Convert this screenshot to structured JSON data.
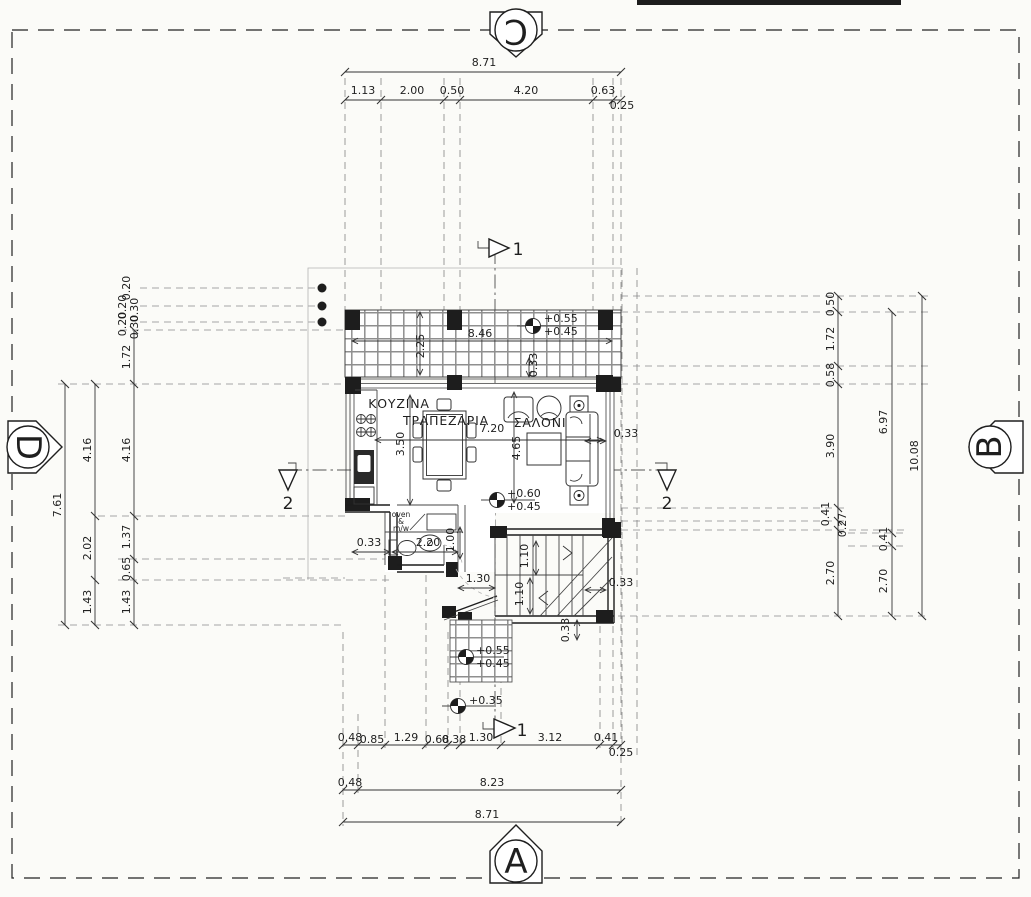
{
  "drawing": {
    "kind": "architectural floor plan",
    "rooms": [
      "ΚΟΥΖΙΝΑ",
      "ΤΡΑΠΕΖΑΡΙΑ",
      "ΣΑΛΟΝΙ"
    ],
    "elevation_markers": [
      {
        "letter": "C",
        "position": "top"
      },
      {
        "letter": "A",
        "position": "bottom"
      },
      {
        "letter": "D",
        "position": "left"
      },
      {
        "letter": "B",
        "position": "right"
      }
    ],
    "section_markers": [
      "1",
      "2"
    ],
    "levels": [
      "+0.55",
      "+0.45",
      "+0.60",
      "+0.45",
      "+0.55",
      "+0.45",
      "+0.35"
    ],
    "colors": {
      "paper": "#fbfbf8",
      "ink": "#1d1d1d",
      "dash": "#8a8a8a",
      "tile": "#8f8f8f"
    }
  },
  "annotations": [
    {
      "t": "8.71",
      "x": 484,
      "y": 66,
      "c": "dim"
    },
    {
      "t": "1.13",
      "x": 363,
      "y": 94,
      "c": "dim"
    },
    {
      "t": "2.00",
      "x": 412,
      "y": 94,
      "c": "dim"
    },
    {
      "t": "0.50",
      "x": 452,
      "y": 94,
      "c": "dim"
    },
    {
      "t": "4.20",
      "x": 526,
      "y": 94,
      "c": "dim"
    },
    {
      "t": "0.63",
      "x": 603,
      "y": 94,
      "c": "dim"
    },
    {
      "t": "0.25",
      "x": 622,
      "y": 109,
      "c": "dim"
    },
    {
      "t": "7.61",
      "x": 61,
      "y": 505,
      "r": -90,
      "c": "dim"
    },
    {
      "t": "4.16",
      "x": 91,
      "y": 450,
      "r": -90,
      "c": "dim"
    },
    {
      "t": "2.02",
      "x": 91,
      "y": 548,
      "r": -90,
      "c": "dim"
    },
    {
      "t": "1.43",
      "x": 91,
      "y": 602,
      "r": -90,
      "c": "dim"
    },
    {
      "t": "0.20",
      "x": 130,
      "y": 288,
      "r": -90,
      "c": "dim"
    },
    {
      "t": "0.20",
      "x": 126,
      "y": 307,
      "r": -90,
      "c": "dim"
    },
    {
      "t": "0.30",
      "x": 138,
      "y": 310,
      "r": -90,
      "c": "dim"
    },
    {
      "t": "0.20",
      "x": 126,
      "y": 324,
      "r": -90,
      "c": "dim"
    },
    {
      "t": "0.30",
      "x": 138,
      "y": 327,
      "r": -90,
      "c": "dim"
    },
    {
      "t": "1.72",
      "x": 130,
      "y": 357,
      "r": -90,
      "c": "dim"
    },
    {
      "t": "4.16",
      "x": 130,
      "y": 450,
      "r": -90,
      "c": "dim"
    },
    {
      "t": "1.37",
      "x": 130,
      "y": 537,
      "r": -90,
      "c": "dim"
    },
    {
      "t": "0.65",
      "x": 130,
      "y": 569,
      "r": -90,
      "c": "dim"
    },
    {
      "t": "1.43",
      "x": 130,
      "y": 602,
      "r": -90,
      "c": "dim"
    },
    {
      "t": "0.50",
      "x": 834,
      "y": 304,
      "r": -90,
      "c": "dim"
    },
    {
      "t": "1.72",
      "x": 834,
      "y": 339,
      "r": -90,
      "c": "dim"
    },
    {
      "t": "0.58",
      "x": 834,
      "y": 375,
      "r": -90,
      "c": "dim"
    },
    {
      "t": "3.90",
      "x": 834,
      "y": 446,
      "r": -90,
      "c": "dim"
    },
    {
      "t": "0.41",
      "x": 829,
      "y": 514,
      "r": -90,
      "c": "dim"
    },
    {
      "t": "0.27",
      "x": 846,
      "y": 525,
      "r": -90,
      "c": "dim"
    },
    {
      "t": "2.70",
      "x": 834,
      "y": 573,
      "r": -90,
      "c": "dim"
    },
    {
      "t": "6.97",
      "x": 887,
      "y": 422,
      "r": -90,
      "c": "dim"
    },
    {
      "t": "0.41",
      "x": 887,
      "y": 539,
      "r": -90,
      "c": "dim"
    },
    {
      "t": "2.70",
      "x": 887,
      "y": 581,
      "r": -90,
      "c": "dim"
    },
    {
      "t": "10.08",
      "x": 918,
      "y": 456,
      "r": -90,
      "c": "dim"
    },
    {
      "t": "0.48",
      "x": 350,
      "y": 741,
      "c": "dim"
    },
    {
      "t": "0.85",
      "x": 372,
      "y": 743,
      "c": "dim"
    },
    {
      "t": "1.29",
      "x": 406,
      "y": 741,
      "c": "dim"
    },
    {
      "t": "0.68",
      "x": 437,
      "y": 743,
      "c": "dim"
    },
    {
      "t": "0.38",
      "x": 454,
      "y": 743,
      "c": "dim"
    },
    {
      "t": "1.30",
      "x": 481,
      "y": 741,
      "c": "dim"
    },
    {
      "t": "3.12",
      "x": 550,
      "y": 741,
      "c": "dim"
    },
    {
      "t": "0.41",
      "x": 606,
      "y": 741,
      "c": "dim"
    },
    {
      "t": "0.25",
      "x": 621,
      "y": 756,
      "c": "dim"
    },
    {
      "t": "0.48",
      "x": 350,
      "y": 786,
      "c": "dim"
    },
    {
      "t": "8.23",
      "x": 492,
      "y": 786,
      "c": "dim"
    },
    {
      "t": "8.71",
      "x": 487,
      "y": 818,
      "c": "dim"
    },
    {
      "t": "8.46",
      "x": 480,
      "y": 337,
      "c": "dim"
    },
    {
      "t": "2.25",
      "x": 424,
      "y": 346,
      "r": -90,
      "c": "dim"
    },
    {
      "t": "0.33",
      "x": 537,
      "y": 365,
      "r": -90,
      "c": "dim"
    },
    {
      "t": "3.50",
      "x": 404,
      "y": 444,
      "r": -90,
      "c": "dim"
    },
    {
      "t": "7.20",
      "x": 492,
      "y": 432,
      "c": "dim"
    },
    {
      "t": "4.65",
      "x": 520,
      "y": 448,
      "r": -90,
      "c": "dim"
    },
    {
      "t": "0.33",
      "x": 626,
      "y": 437,
      "c": "dim"
    },
    {
      "t": "0.33",
      "x": 369,
      "y": 546,
      "c": "dim"
    },
    {
      "t": "2.20",
      "x": 428,
      "y": 546,
      "c": "dim"
    },
    {
      "t": "1.00",
      "x": 454,
      "y": 540,
      "r": -90,
      "c": "dim"
    },
    {
      "t": "1.30",
      "x": 478,
      "y": 582,
      "c": "dim"
    },
    {
      "t": "1.10",
      "x": 528,
      "y": 556,
      "r": -90,
      "c": "dim"
    },
    {
      "t": "1.10",
      "x": 523,
      "y": 594,
      "r": -90,
      "c": "dim"
    },
    {
      "t": "0.33",
      "x": 621,
      "y": 586,
      "c": "dim"
    },
    {
      "t": "0.33",
      "x": 569,
      "y": 630,
      "r": -90,
      "c": "dim"
    },
    {
      "t": "ΚΟΥΖΙΝΑ",
      "x": 399,
      "y": 408,
      "c": "room"
    },
    {
      "t": "ΤΡΑΠΕΖΑΡΙΑ",
      "x": 446,
      "y": 425,
      "c": "room"
    },
    {
      "t": "ΣΑΛΟΝΙ",
      "x": 540,
      "y": 427,
      "c": "room"
    },
    {
      "t": "oven",
      "x": 401,
      "y": 517,
      "c": "small"
    },
    {
      "t": "&",
      "x": 401,
      "y": 524,
      "c": "small"
    },
    {
      "t": "m/w",
      "x": 401,
      "y": 531,
      "c": "small"
    },
    {
      "t": "+0.55",
      "x": 544,
      "y": 322,
      "c": "level"
    },
    {
      "t": "+0.45",
      "x": 544,
      "y": 335,
      "c": "level"
    },
    {
      "t": "+0.60",
      "x": 507,
      "y": 497,
      "c": "level"
    },
    {
      "t": "+0.45",
      "x": 507,
      "y": 510,
      "c": "level"
    },
    {
      "t": "+0.55",
      "x": 476,
      "y": 654,
      "c": "level"
    },
    {
      "t": "+0.45",
      "x": 476,
      "y": 667,
      "c": "level"
    },
    {
      "t": "+0.35",
      "x": 469,
      "y": 704,
      "c": "level"
    },
    {
      "t": "1",
      "x": 518,
      "y": 255,
      "c": "sec"
    },
    {
      "t": "1",
      "x": 522,
      "y": 736,
      "c": "sec"
    },
    {
      "t": "2",
      "x": 288,
      "y": 509,
      "c": "sec"
    },
    {
      "t": "2",
      "x": 667,
      "y": 509,
      "c": "sec"
    },
    {
      "t": "C",
      "x": 516,
      "y": 31,
      "r": 180,
      "c": "marker"
    },
    {
      "t": "A",
      "x": 516,
      "y": 862,
      "c": "marker"
    },
    {
      "t": "D",
      "x": 28,
      "y": 447,
      "r": 90,
      "c": "marker"
    },
    {
      "t": "B",
      "x": 990,
      "y": 447,
      "r": -90,
      "c": "marker"
    }
  ]
}
